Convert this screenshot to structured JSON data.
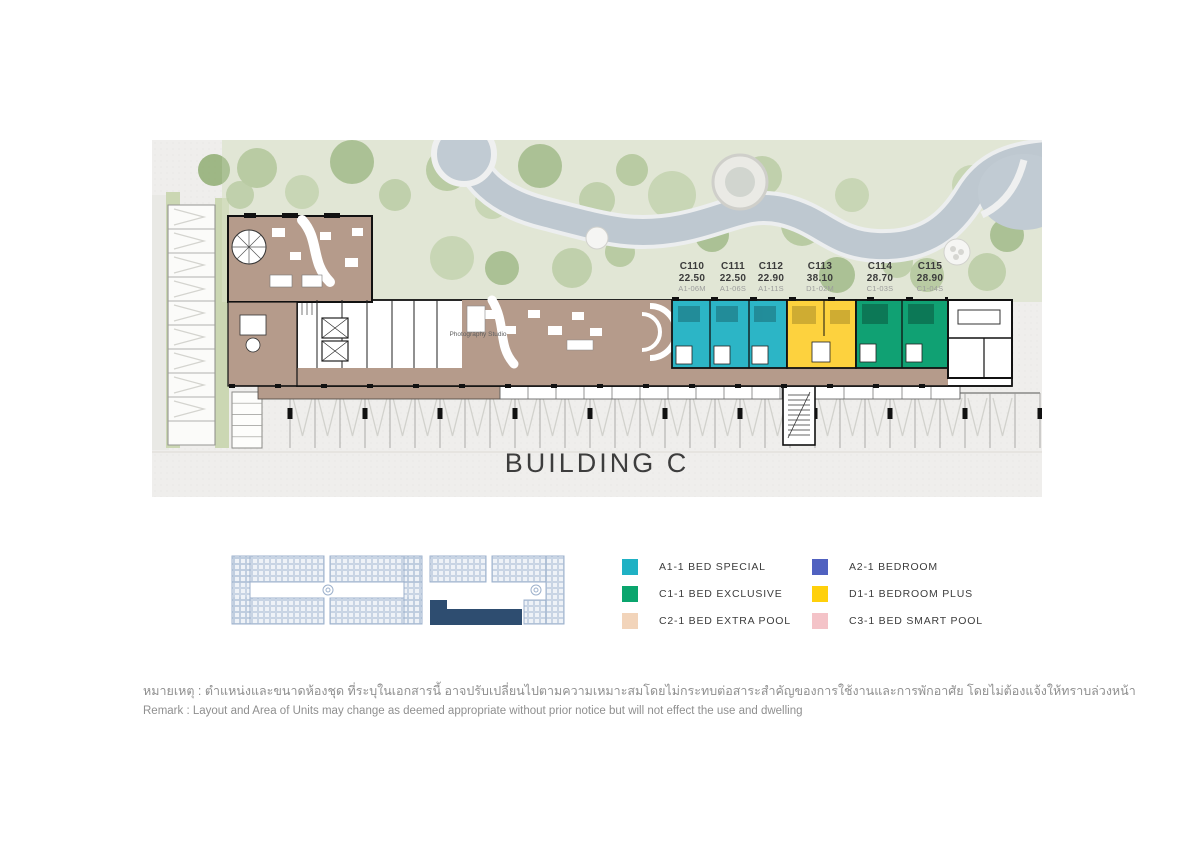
{
  "plan": {
    "title": "BUILDING C",
    "room_label": "Photography Studio",
    "units": [
      {
        "unit": "C110",
        "area": "22.50",
        "type": "A1-06M",
        "x": 540
      },
      {
        "unit": "C111",
        "area": "22.50",
        "type": "A1-06S",
        "x": 581
      },
      {
        "unit": "C112",
        "area": "22.90",
        "type": "A1-11S",
        "x": 619
      },
      {
        "unit": "C113",
        "area": "38.10",
        "type": "D1-02M",
        "x": 668
      },
      {
        "unit": "C114",
        "area": "28.70",
        "type": "C1-03S",
        "x": 728
      },
      {
        "unit": "C115",
        "area": "28.90",
        "type": "C1-04S",
        "x": 778
      }
    ],
    "unit_colors": {
      "teal": "#2cb5c6",
      "yellow": "#fdd23e",
      "green": "#10a173",
      "common": "#b59b8b"
    }
  },
  "keyplan": {
    "highlight_color": "#2e4d70"
  },
  "legend": {
    "items": [
      {
        "label": "A1-1 BED SPECIAL",
        "color": "#1fb1c4"
      },
      {
        "label": "C1-1 BED EXCLUSIVE",
        "color": "#0aa56d"
      },
      {
        "label": "C2-1 BED EXTRA POOL",
        "color": "#f2d4ba"
      },
      {
        "label": "A2-1 BEDROOM",
        "color": "#5061c0"
      },
      {
        "label": "D1-1 BEDROOM PLUS",
        "color": "#ffd00b"
      },
      {
        "label": "C3-1 BED SMART POOL",
        "color": "#f4c3c8"
      }
    ]
  },
  "remark": {
    "thai": "หมายเหตุ : ตำแหน่งและขนาดห้องชุด ที่ระบุในเอกสารนี้ อาจปรับเปลี่ยนไปตามความเหมาะสมโดยไม่กระทบต่อสาระสำคัญของการใช้งานและการพักอาศัย โดยไม่ต้องแจ้งให้ทราบล่วงหน้า",
    "english": "Remark : Layout and Area of Units may change as deemed appropriate without prior notice but will not effect the use and dwelling"
  }
}
